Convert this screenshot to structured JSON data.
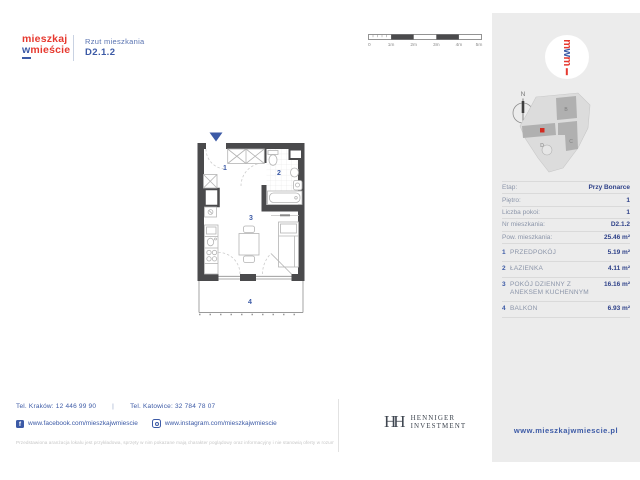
{
  "header": {
    "logo_line1": "mieszkaj",
    "logo_w": "w",
    "logo_line2_rest": "mieście",
    "doc_type": "Rzut mieszkania",
    "unit_code": "D2.1.2"
  },
  "scalebar": {
    "labels": [
      "0",
      "1m",
      "2m",
      "3m",
      "4m",
      "5m"
    ]
  },
  "sidebar": {
    "monogram": {
      "top": "m",
      "mid": "w",
      "bottom": "m"
    },
    "compass_label": "N",
    "siteplan_buildings": [
      "B",
      "D",
      "C"
    ],
    "info": [
      {
        "label": "Etap:",
        "value": "Przy Bonarce"
      },
      {
        "label": "Piętro:",
        "value": "1"
      },
      {
        "label": "Liczba pokoi:",
        "value": "1"
      },
      {
        "label": "Nr mieszkania:",
        "value": "D2.1.2"
      },
      {
        "label": "Pow. mieszkania:",
        "value": "25.46 m²"
      }
    ],
    "rooms": [
      {
        "num": "1",
        "name": "PRZEDPOKÓJ",
        "area": "5.19 m²"
      },
      {
        "num": "2",
        "name": "ŁAZIENKA",
        "area": "4.11 m²"
      },
      {
        "num": "3",
        "name": "POKÓJ DZIENNY Z ANEKSEM KUCHENNYM",
        "area": "16.16 m²"
      },
      {
        "num": "4",
        "name": "BALKON",
        "area": "6.93 m²"
      }
    ],
    "website": "www.mieszkajwmiescie.pl"
  },
  "plan": {
    "room_numbers": [
      "1",
      "2",
      "3",
      "4"
    ]
  },
  "footer": {
    "tel_krakow": "Tel. Kraków: 12 446 99 90",
    "tel_separator": "|",
    "tel_katowice": "Tel. Katowice: 32 784 78 07",
    "facebook_icon_letter": "f",
    "facebook": "www.facebook.com/mieszkajwmiescie",
    "instagram": "www.instagram.com/mieszkajwmiescie",
    "disclaimer": "Przedstawiona aranżacja lokalu jest przykładowa, sprzęty w nim pokazane mają charakter poglądowy oraz informacyjny i nie stanowią oferty w rozumieniu Kodeksu Cywilnego.",
    "developer_monogram": "HH",
    "developer_line1": "HENNIGER",
    "developer_line2": "INVESTMENT"
  },
  "colors": {
    "accent_blue": "#3c5aa6",
    "value_navy": "#2e4189",
    "brand_red": "#e6392f",
    "wall_dark": "#4a4a4c",
    "sidebar_gray": "#ececec",
    "site_red_dot": "#d32b20"
  }
}
